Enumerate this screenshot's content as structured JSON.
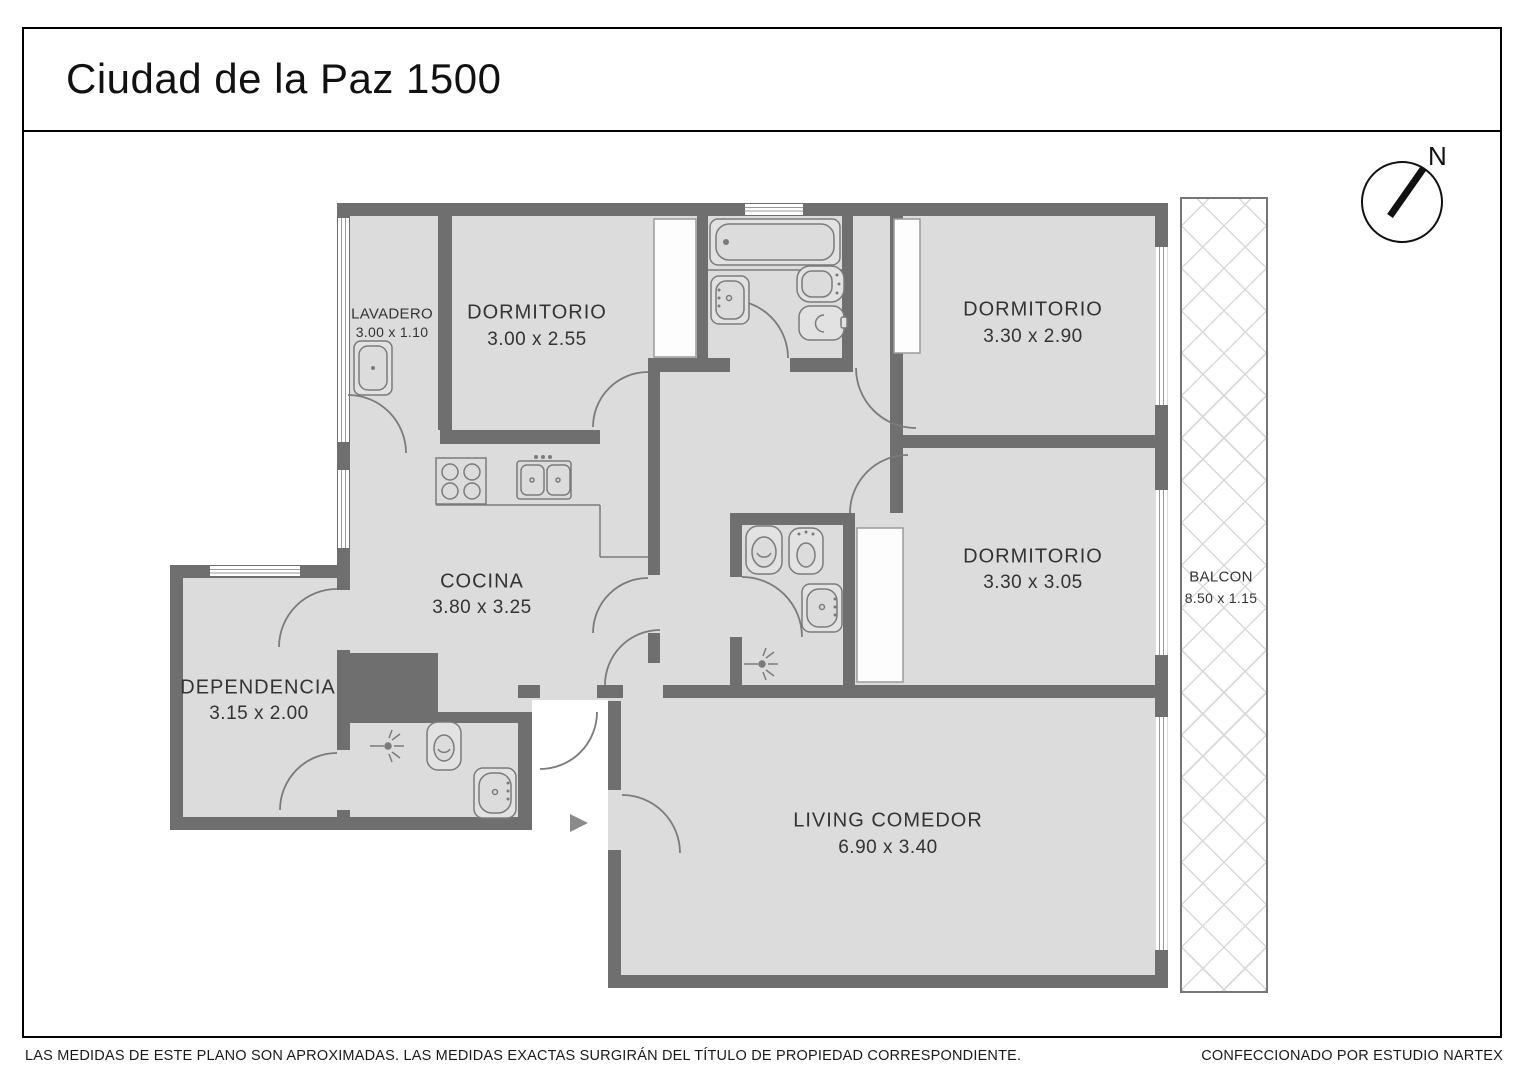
{
  "page": {
    "title": "Ciudad de la Paz 1500",
    "compass_label": "N",
    "footer_left": "LAS MEDIDAS  DE ESTE PLANO SON APROXIMADAS. LAS MEDIDAS EXACTAS SURGIRÁN DEL TÍTULO DE PROPIEDAD CORRESPONDIENTE.",
    "footer_right": "CONFECCIONADO POR ESTUDIO NARTEX"
  },
  "rooms": [
    {
      "id": "lavadero",
      "name": "LAVADERO",
      "dims": "3.00 x 1.10"
    },
    {
      "id": "dormitorio-1",
      "name": "DORMITORIO",
      "dims": "3.00 x 2.55"
    },
    {
      "id": "dormitorio-2",
      "name": "DORMITORIO",
      "dims": "3.30 x 2.90"
    },
    {
      "id": "dormitorio-3",
      "name": "DORMITORIO",
      "dims": "3.30 x 3.05"
    },
    {
      "id": "cocina",
      "name": "COCINA",
      "dims": "3.80 x 3.25"
    },
    {
      "id": "dependencia",
      "name": "DEPENDENCIA",
      "dims": "3.15 x 2.00"
    },
    {
      "id": "living",
      "name": "LIVING COMEDOR",
      "dims": "6.90 x 3.40"
    },
    {
      "id": "balcon",
      "name": "BALCON",
      "dims": "8.50 x 1.15"
    }
  ],
  "entry_arrow_direction": "right",
  "colors": {
    "wall": "#6f6f6f",
    "floor": "#dcdcdc",
    "fixture_line": "#7b7b7b",
    "balcony_hatch": "#d9d9d9",
    "text": "#333333",
    "frame": "#000000"
  }
}
